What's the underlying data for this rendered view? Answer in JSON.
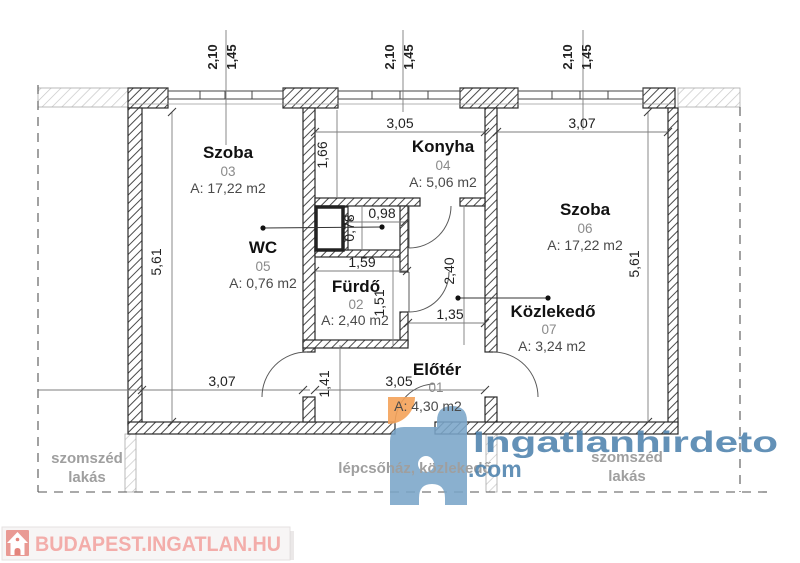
{
  "plan": {
    "rooms": {
      "szoba03": {
        "name": "Szoba",
        "number": "03",
        "area": "A: 17,22 m2"
      },
      "konyha": {
        "name": "Konyha",
        "number": "04",
        "area": "A: 5,06 m2"
      },
      "wc": {
        "name": "WC",
        "number": "05",
        "area": "A: 0,76 m2"
      },
      "furdo": {
        "name": "Fürdő",
        "number": "02",
        "area": "A: 2,40 m2"
      },
      "szoba06": {
        "name": "Szoba",
        "number": "06",
        "area": "A: 17,22 m2"
      },
      "kozlekedo": {
        "name": "Közlekedő",
        "number": "07",
        "area": "A: 3,24 m2"
      },
      "eloter": {
        "name": "Előtér",
        "number": "01",
        "area": "A: 4,30 m2"
      }
    },
    "dims": {
      "top1a": "2,10",
      "top1b": "1,45",
      "top2a": "2,10",
      "top2b": "1,45",
      "top3a": "2,10",
      "top3b": "1,45",
      "konyha_w": "3,05",
      "szoba06_w": "3,07",
      "left_h": "5,61",
      "right_h": "5,61",
      "konyha_h": "1,66",
      "wc_w": "0,98",
      "wc_h": "0,78",
      "furdo_w": "1,59",
      "furdo_h": "1,51",
      "corridor_h": "2,40",
      "corridor_w": "1,35",
      "szoba03_w": "3,07",
      "eloter_h": "1,41",
      "eloter_w": "3,05"
    },
    "context": {
      "neighbor_left_1": "szomszéd",
      "neighbor_left_2": "lakás",
      "stairwell": "lépcsőház, közlekedő",
      "neighbor_right_1": "szomszéd",
      "neighbor_right_2": "lakás"
    }
  },
  "watermark": {
    "brand": "Ingatlanhirdeto",
    "tld": ".com"
  },
  "footer": {
    "site": "BUDAPEST.INGATLAN.HU"
  },
  "colors": {
    "logo_blue": "#7aa5c8",
    "watermark_blue": "#4d82ad",
    "logo_orange": "#f4a259",
    "footer_red": "#e2776e",
    "footer_text": "#f2a5a1"
  }
}
